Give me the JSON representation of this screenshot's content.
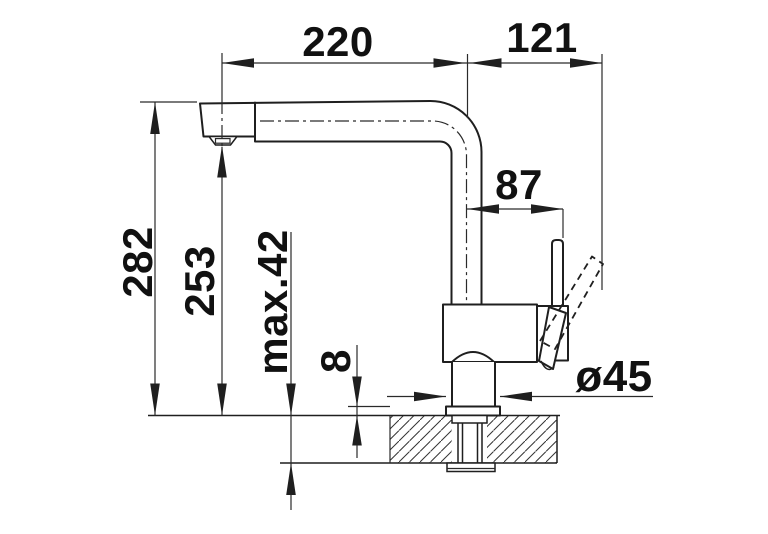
{
  "drawing": {
    "type": "technical-dimension-drawing",
    "subject": "single-lever kitchen mixer tap, side elevation with countertop cross-section",
    "line_color": "#1f1f1f",
    "background_color": "#ffffff",
    "labels": {
      "spout_reach": "220",
      "rear_extent": "121",
      "handle_reach": "87",
      "overall_height": "282",
      "outlet_height": "253",
      "max_counter_thickness": "max.42",
      "base_plate_height": "8",
      "base_diameter": "ø45"
    }
  }
}
